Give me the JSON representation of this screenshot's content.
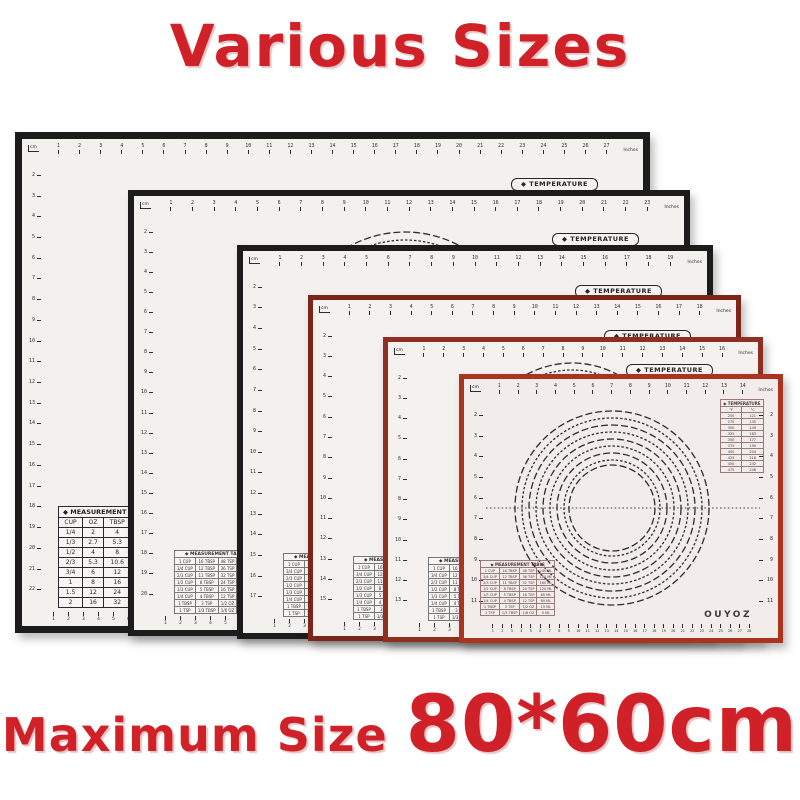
{
  "title": {
    "text": "Various Sizes",
    "color": "#cf2127"
  },
  "footer": {
    "prefix": "Maximum Size",
    "size": "80*60cm",
    "color": "#cf2127"
  },
  "shared": {
    "corner_unit": "cm",
    "inches_label": "Inches",
    "temperature_pill": "◆ TEMPERATURE",
    "temperature_table": {
      "header": "◆ TEMPERATURE",
      "columns": [
        "°F",
        "°C"
      ],
      "rows": [
        [
          "250",
          "121"
        ],
        [
          "275",
          "135"
        ],
        [
          "300",
          "149"
        ],
        [
          "325",
          "163"
        ],
        [
          "350",
          "177"
        ],
        [
          "375",
          "190"
        ],
        [
          "400",
          "204"
        ],
        [
          "425",
          "218"
        ],
        [
          "450",
          "232"
        ],
        [
          "475",
          "246"
        ]
      ]
    },
    "measurement_large": {
      "header": "◆ MEASUREMENT",
      "columns": [
        "CUP",
        "OZ",
        "TBSP"
      ],
      "rows": [
        [
          "1/4",
          "2",
          "4"
        ],
        [
          "1/3",
          "2.7",
          "5.3"
        ],
        [
          "1/2",
          "4",
          "8"
        ],
        [
          "2/3",
          "5.3",
          "10.6"
        ],
        [
          "3/4",
          "6",
          "12"
        ],
        [
          "1",
          "8",
          "16"
        ],
        [
          "1.5",
          "12",
          "24"
        ],
        [
          "2",
          "16",
          "32"
        ]
      ]
    },
    "measurement_small": {
      "header": "◆ MEASUREMENT TABLE",
      "rows": [
        [
          "1 CUP",
          "16 TBSP",
          "48 TSP",
          "240 ML"
        ],
        [
          "3/4 CUP",
          "12 TBSP",
          "36 TSP",
          "180 ML"
        ],
        [
          "2/3 CUP",
          "11 TBSP",
          "32 TSP",
          "160 ML"
        ],
        [
          "1/2 CUP",
          "8 TBSP",
          "24 TSP",
          "120 ML"
        ],
        [
          "1/3 CUP",
          "5 TBSP",
          "16 TSP",
          "80 ML"
        ],
        [
          "1/4 CUP",
          "4 TBSP",
          "12 TSP",
          "60 ML"
        ],
        [
          "1 TBSP",
          "3 TSP",
          "1/2 OZ",
          "15 ML"
        ],
        [
          "1 TSP",
          "1/3 TBSP",
          "1/6 OZ",
          "5 ML"
        ]
      ]
    },
    "logo": "OUYOZ"
  },
  "mats": [
    {
      "x": 15,
      "y": 132,
      "w": 635,
      "h": 501,
      "border_width": 7,
      "border_color": "#1c1c1c",
      "surface": "#f3f1ee",
      "top_ticks": 27,
      "left_ticks": 21,
      "bottom_ticks": 8,
      "pill_top": 39,
      "measurement": "large"
    },
    {
      "x": 128,
      "y": 190,
      "w": 562,
      "h": 446,
      "border_width": 6,
      "border_color": "#1c1c1c",
      "surface": "#f3f1ee",
      "top_ticks": 23,
      "left_ticks": 19,
      "bottom_ticks": 8,
      "pill_top": 37,
      "measurement": "small",
      "circles": {
        "cx": 271,
        "cy": 151,
        "radii": [
          115,
          107,
          99
        ]
      }
    },
    {
      "x": 237,
      "y": 245,
      "w": 476,
      "h": 394,
      "border_width": 6,
      "border_color": "#1c1c1c",
      "surface": "#f3f1ee",
      "top_ticks": 19,
      "left_ticks": 16,
      "bottom_ticks": 8,
      "pill_top": 34,
      "measurement": "small"
    },
    {
      "x": 308,
      "y": 295,
      "w": 433,
      "h": 346,
      "border_width": 5,
      "border_color": "#7c251b",
      "surface": "#f4f1ef",
      "top_ticks": 18,
      "left_ticks": 14,
      "bottom_ticks": 8,
      "pill_top": 30,
      "measurement": "small"
    },
    {
      "x": 383,
      "y": 337,
      "w": 380,
      "h": 305,
      "border_width": 5,
      "border_color": "#8f2f21",
      "surface": "#f4f1ef",
      "top_ticks": 16,
      "left_ticks": 12,
      "bottom_ticks": 8,
      "pill_top": 22,
      "measurement": "small",
      "circles": {
        "cx": 184,
        "cy": 116,
        "radii": [
          95,
          88,
          81
        ]
      }
    },
    {
      "x": 459,
      "y": 374,
      "w": 324,
      "h": 269,
      "border_width": 5,
      "border_color": "#aa341f",
      "surface": "#f2edeb",
      "top_ticks": 14,
      "left_ticks": 10,
      "right_ticks": 10,
      "bottom_ticks": 28,
      "measurement": "front",
      "temp_table": true,
      "logo": true,
      "circles": {
        "cx": 148,
        "cy": 129,
        "radii": [
          97,
          90,
          83,
          76,
          69,
          62,
          55,
          48,
          43
        ],
        "line": true
      }
    }
  ]
}
